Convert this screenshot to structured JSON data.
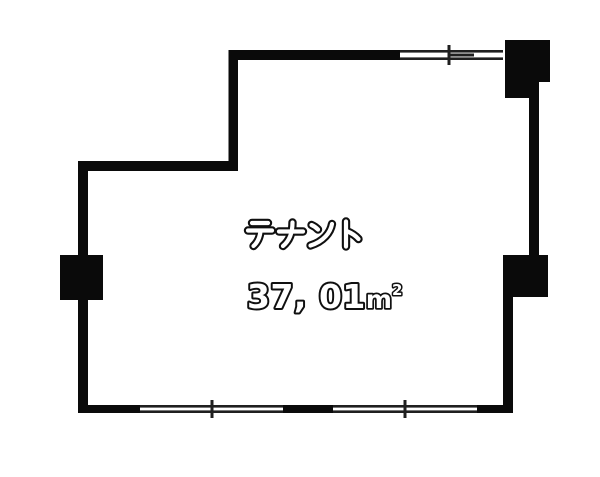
{
  "canvas": {
    "width": 600,
    "height": 477,
    "bg": "#ffffff"
  },
  "colors": {
    "wall": "#0a0a0a",
    "line": "#1f1f1f",
    "text_fill": "#ffffff",
    "text_outline": "#101010"
  },
  "room": {
    "label": "テナント",
    "area_value": "37, 01",
    "area_unit_m": "m",
    "area_unit_exp": "2",
    "area_full_text": "37, 01㎡"
  },
  "floorplan": {
    "walls": [
      {
        "name": "top",
        "x": 229,
        "y": 50,
        "w": 171,
        "h": 10
      },
      {
        "name": "upper-left",
        "x": 228.5,
        "y": 50,
        "w": 9.5,
        "h": 121
      },
      {
        "name": "step",
        "x": 78,
        "y": 161,
        "w": 160,
        "h": 10
      },
      {
        "name": "left",
        "x": 78,
        "y": 161,
        "w": 10,
        "h": 252
      },
      {
        "name": "bottom-left",
        "x": 78,
        "y": 405,
        "w": 62,
        "h": 8
      },
      {
        "name": "bottom-middle",
        "x": 283,
        "y": 405,
        "w": 50,
        "h": 8
      },
      {
        "name": "bottom-right",
        "x": 477,
        "y": 405,
        "w": 36,
        "h": 8
      },
      {
        "name": "right-lower",
        "x": 503,
        "y": 297,
        "w": 10,
        "h": 116
      },
      {
        "name": "right-upper",
        "x": 529,
        "y": 93,
        "w": 10,
        "h": 162
      }
    ],
    "pillars": [
      {
        "name": "top-right",
        "points": "505,40 550,40 550,82 539,82 539,98 505,98"
      },
      {
        "name": "left",
        "x": 60,
        "y": 255,
        "w": 43,
        "h": 45
      },
      {
        "name": "bottom-right",
        "x": 503,
        "y": 255,
        "w": 45,
        "h": 42
      }
    ],
    "windows": [
      {
        "name": "window-top",
        "x1": 400,
        "x2": 503,
        "y": 50,
        "band": 10,
        "ticks": [
          449
        ],
        "sash": {
          "x1": 450,
          "x2": 474
        }
      },
      {
        "name": "window-bottom-left",
        "x1": 140,
        "x2": 283,
        "y": 405,
        "band": 8,
        "ticks": [
          212
        ]
      },
      {
        "name": "window-bottom-right",
        "x1": 333,
        "x2": 477,
        "y": 405,
        "band": 8,
        "ticks": [
          405
        ]
      }
    ]
  },
  "label_glyphs": [
    {
      "char": "テ",
      "x": 245,
      "y": 219,
      "strokes": [
        "M7 4 L23 4",
        "M3 11.5 L27 11.5",
        "M15.5 12 C15 17.5 13.5 22.5 8.5 27"
      ]
    },
    {
      "char": "ナ",
      "x": 276,
      "y": 219,
      "strokes": [
        "M3 12.5 L27 12.5",
        "M16.5 3.5 C16.5 11 15 20.5 7 27"
      ]
    },
    {
      "char": "ン",
      "x": 307,
      "y": 219,
      "strokes": [
        "M4.5 6 C7 7 9 8.5 11 10.5",
        "M25 5 C23.5 13.5 16.5 22.5 3.5 26.5"
      ]
    },
    {
      "char": "ト",
      "x": 338,
      "y": 219,
      "strokes": [
        "M8 2.5 L8 27.5",
        "M8.5 12 C13.5 14 17.5 16.5 20.5 20"
      ]
    }
  ]
}
